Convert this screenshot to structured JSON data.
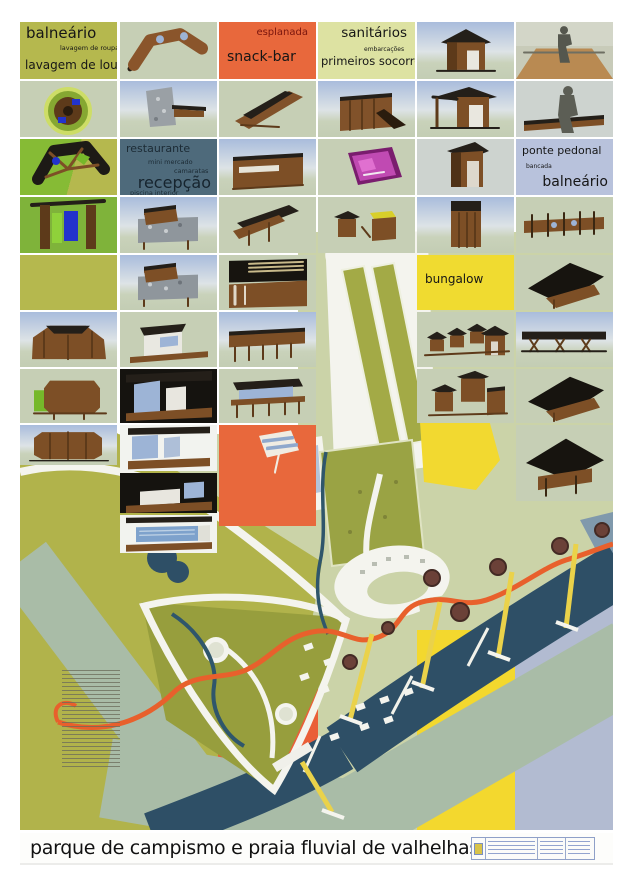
{
  "title_bar": {
    "title": "parque de campismo e praia fluvial de valhelhas"
  },
  "labels": {
    "b1": {
      "l1": "balneário",
      "l2": "lavagem de roupa",
      "l3": "lavagem de louça"
    },
    "b2": {
      "l1": "esplanada",
      "l2": "snack-bar"
    },
    "b3": {
      "l1": "sanitários",
      "l2": "embarcações",
      "l3": "primeiros socorros"
    },
    "b4": {
      "l1": "restaurante",
      "l2": "mini mercado",
      "l3": "camaratas",
      "l4": "recepção",
      "l5": "piscina interior"
    },
    "b5": {
      "l1": "ponte pedonal",
      "l2": "bancada",
      "l3": "balneário"
    },
    "b6": {
      "l1": "bungalow"
    }
  },
  "palette": {
    "poster_olive": "#b5b84e",
    "orange": "#e8683c",
    "pale_yellow_green": "#dde2a2",
    "slate_blue": "#4e6a7b",
    "light_blue": "#b8c2dc",
    "bungalow_yellow": "#f0db30",
    "plan_base_green": "#cbd3a8",
    "plan_olive": "#b1b34b",
    "campsite_olive": "#979e3d",
    "river_blue": "#2e4f66",
    "beach_grey_green": "#a9bca7",
    "path_orange": "#e8602c",
    "pier_yellow": "#ead24a",
    "band_yellow": "#f3d82e",
    "band_blue_grey": "#b2bbd1",
    "wood_brown": "#7d4f26",
    "roof_dark": "#241f19",
    "road_white": "#f4f4ee",
    "title_color": "#111111"
  },
  "collage": {
    "cells": [
      {
        "x": 0,
        "y": 0,
        "w": 97,
        "h": 57,
        "t": "label",
        "b": "b1",
        "bg": "olive"
      },
      {
        "x": 100,
        "y": 0,
        "w": 97,
        "h": 57,
        "t": "r",
        "k": "curvedplan",
        "bg": "sage"
      },
      {
        "x": 199,
        "y": 0,
        "w": 97,
        "h": 57,
        "t": "label",
        "b": "b2",
        "bg": "orange"
      },
      {
        "x": 298,
        "y": 0,
        "w": 97,
        "h": 57,
        "t": "label",
        "b": "b3",
        "bg": "pale"
      },
      {
        "x": 397,
        "y": 0,
        "w": 97,
        "h": 57,
        "t": "r",
        "k": "hut",
        "bg": "sky"
      },
      {
        "x": 496,
        "y": 0,
        "w": 97,
        "h": 57,
        "t": "r",
        "k": "persondeck",
        "bg": "tan"
      },
      {
        "x": 0,
        "y": 59,
        "w": 97,
        "h": 56,
        "t": "r",
        "k": "circplan",
        "bg": "sage"
      },
      {
        "x": 100,
        "y": 59,
        "w": 97,
        "h": 56,
        "t": "r",
        "k": "stone",
        "bg": "sky"
      },
      {
        "x": 199,
        "y": 59,
        "w": 97,
        "h": 56,
        "t": "r",
        "k": "slope",
        "bg": "sage"
      },
      {
        "x": 298,
        "y": 59,
        "w": 97,
        "h": 56,
        "t": "r",
        "k": "box",
        "bg": "sky"
      },
      {
        "x": 397,
        "y": 59,
        "w": 97,
        "h": 56,
        "t": "r",
        "k": "hutporch",
        "bg": "sky"
      },
      {
        "x": 496,
        "y": 59,
        "w": 97,
        "h": 56,
        "t": "r",
        "k": "person",
        "bg": "grey"
      },
      {
        "x": 0,
        "y": 117,
        "w": 97,
        "h": 56,
        "t": "r",
        "k": "wheel",
        "bg": "greensplit"
      },
      {
        "x": 100,
        "y": 117,
        "w": 97,
        "h": 56,
        "t": "label",
        "b": "b4",
        "bg": "slate"
      },
      {
        "x": 199,
        "y": 117,
        "w": 97,
        "h": 56,
        "t": "r",
        "k": "longbldg",
        "bg": "sky"
      },
      {
        "x": 298,
        "y": 117,
        "w": 97,
        "h": 56,
        "t": "r",
        "k": "magenta",
        "bg": "sage"
      },
      {
        "x": 397,
        "y": 117,
        "w": 97,
        "h": 56,
        "t": "r",
        "k": "tallhut",
        "bg": "grey"
      },
      {
        "x": 496,
        "y": 117,
        "w": 97,
        "h": 56,
        "t": "label",
        "b": "b5",
        "bg": "lightblue"
      },
      {
        "x": 0,
        "y": 175,
        "w": 97,
        "h": 56,
        "t": "r",
        "k": "greenint",
        "bg": "green"
      },
      {
        "x": 100,
        "y": 175,
        "w": 97,
        "h": 56,
        "t": "r",
        "k": "stonelong",
        "bg": "sky"
      },
      {
        "x": 199,
        "y": 175,
        "w": 97,
        "h": 56,
        "t": "r",
        "k": "ramp",
        "bg": "sage"
      },
      {
        "x": 298,
        "y": 175,
        "w": 97,
        "h": 56,
        "t": "r",
        "k": "twohuts",
        "bg": "sage"
      },
      {
        "x": 397,
        "y": 175,
        "w": 97,
        "h": 56,
        "t": "r",
        "k": "towerhut",
        "bg": "sky"
      },
      {
        "x": 496,
        "y": 175,
        "w": 97,
        "h": 56,
        "t": "r",
        "k": "planwalk",
        "bg": "sage"
      },
      {
        "x": 0,
        "y": 233,
        "w": 97,
        "h": 55,
        "t": "r",
        "k": "blank",
        "bg": "olive"
      },
      {
        "x": 100,
        "y": 233,
        "w": 97,
        "h": 55,
        "t": "r",
        "k": "stonelong",
        "bg": "sky"
      },
      {
        "x": 199,
        "y": 233,
        "w": 97,
        "h": 55,
        "t": "r",
        "k": "intcanopy",
        "bg": "sage"
      },
      {
        "x": 397,
        "y": 233,
        "w": 97,
        "h": 55,
        "t": "label",
        "b": "b6",
        "bg": "yellow"
      },
      {
        "x": 496,
        "y": 233,
        "w": 97,
        "h": 55,
        "t": "r",
        "k": "darkroof",
        "bg": "sage"
      },
      {
        "x": 0,
        "y": 290,
        "w": 97,
        "h": 55,
        "t": "r",
        "k": "curve",
        "bg": "sky"
      },
      {
        "x": 100,
        "y": 290,
        "w": 97,
        "h": 55,
        "t": "r",
        "k": "whitebldg",
        "bg": "sage"
      },
      {
        "x": 199,
        "y": 290,
        "w": 97,
        "h": 55,
        "t": "r",
        "k": "stiltlong",
        "bg": "sky"
      },
      {
        "x": 397,
        "y": 290,
        "w": 97,
        "h": 55,
        "t": "r",
        "k": "bungalowrow",
        "bg": "sage"
      },
      {
        "x": 496,
        "y": 290,
        "w": 97,
        "h": 55,
        "t": "r",
        "k": "bridgeelev",
        "bg": "sky"
      },
      {
        "x": 0,
        "y": 347,
        "w": 97,
        "h": 54,
        "t": "r",
        "k": "cylgreen",
        "bg": "sage"
      },
      {
        "x": 100,
        "y": 347,
        "w": 97,
        "h": 54,
        "t": "r",
        "k": "intglass",
        "bg": "dark"
      },
      {
        "x": 199,
        "y": 347,
        "w": 97,
        "h": 54,
        "t": "r",
        "k": "stiltpav",
        "bg": "sage"
      },
      {
        "x": 397,
        "y": 347,
        "w": 97,
        "h": 54,
        "t": "r",
        "k": "bungalowcluster",
        "bg": "sage"
      },
      {
        "x": 496,
        "y": 347,
        "w": 97,
        "h": 54,
        "t": "r",
        "k": "darkroof",
        "bg": "sage"
      },
      {
        "x": 0,
        "y": 403,
        "w": 97,
        "h": 40,
        "t": "r",
        "k": "cyl",
        "bg": "sky"
      },
      {
        "x": 100,
        "y": 403,
        "w": 97,
        "h": 46,
        "t": "r",
        "k": "bath",
        "bg": "white"
      },
      {
        "x": 100,
        "y": 451,
        "w": 97,
        "h": 40,
        "t": "r",
        "k": "bed",
        "bg": "dark"
      },
      {
        "x": 100,
        "y": 493,
        "w": 97,
        "h": 38,
        "t": "r",
        "k": "pool",
        "bg": "white"
      },
      {
        "x": 199,
        "y": 403,
        "w": 97,
        "h": 101,
        "t": "r",
        "k": "sketch",
        "bg": "orange"
      },
      {
        "x": 496,
        "y": 403,
        "w": 97,
        "h": 76,
        "t": "r",
        "k": "bridgeroof",
        "bg": "sage"
      }
    ]
  }
}
